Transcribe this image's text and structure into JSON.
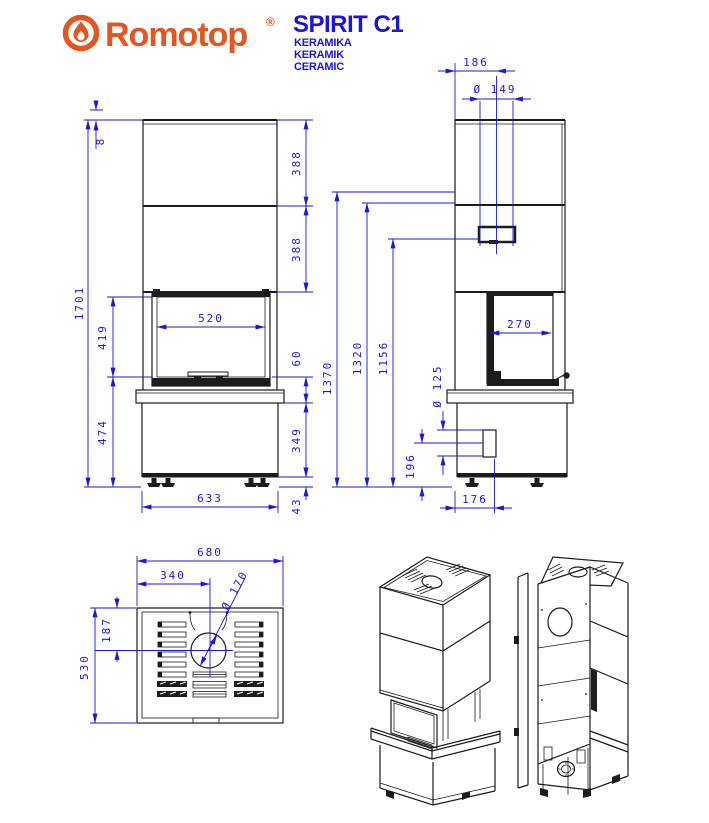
{
  "header": {
    "brand": "Romotop",
    "registered": "®",
    "model": "SPIRIT C1",
    "subtitle": [
      "KERAMIKA",
      "KERAMIK",
      "CERAMIC"
    ],
    "colors": {
      "brand_orange": "#e65420",
      "accent_blue": "#1c17dd",
      "line_black": "#1c1c1c"
    }
  },
  "views": {
    "front": {
      "label": "front view",
      "dims": {
        "top_plate": "8",
        "overall_height": "1701",
        "glass_height": "419",
        "pedestal_height": "474",
        "upper_panel": "388",
        "lower_panel": "388",
        "glass_width": "520",
        "door_to_shelf": "60",
        "base_height": "349",
        "base_width": "633",
        "feet_height": "43"
      }
    },
    "side": {
      "label": "side view",
      "dims": {
        "flue_offset": "186",
        "flue_diameter": "Ø 149",
        "height_total": "1370",
        "height_flue_center": "1320",
        "height_rear_outlet": "1156",
        "side_glass_width": "270",
        "air_inlet_diameter": "Ø 125",
        "air_inlet_height": "196",
        "air_inlet_offset": "176"
      }
    },
    "top": {
      "label": "top view",
      "dims": {
        "width": "680",
        "flue_center_x": "340",
        "flue_hole_diameter": "Ø 170",
        "flue_center_y": "187",
        "depth": "530"
      }
    },
    "iso_front": {
      "label": "isometric front view"
    },
    "iso_rear": {
      "label": "isometric rear view"
    }
  }
}
